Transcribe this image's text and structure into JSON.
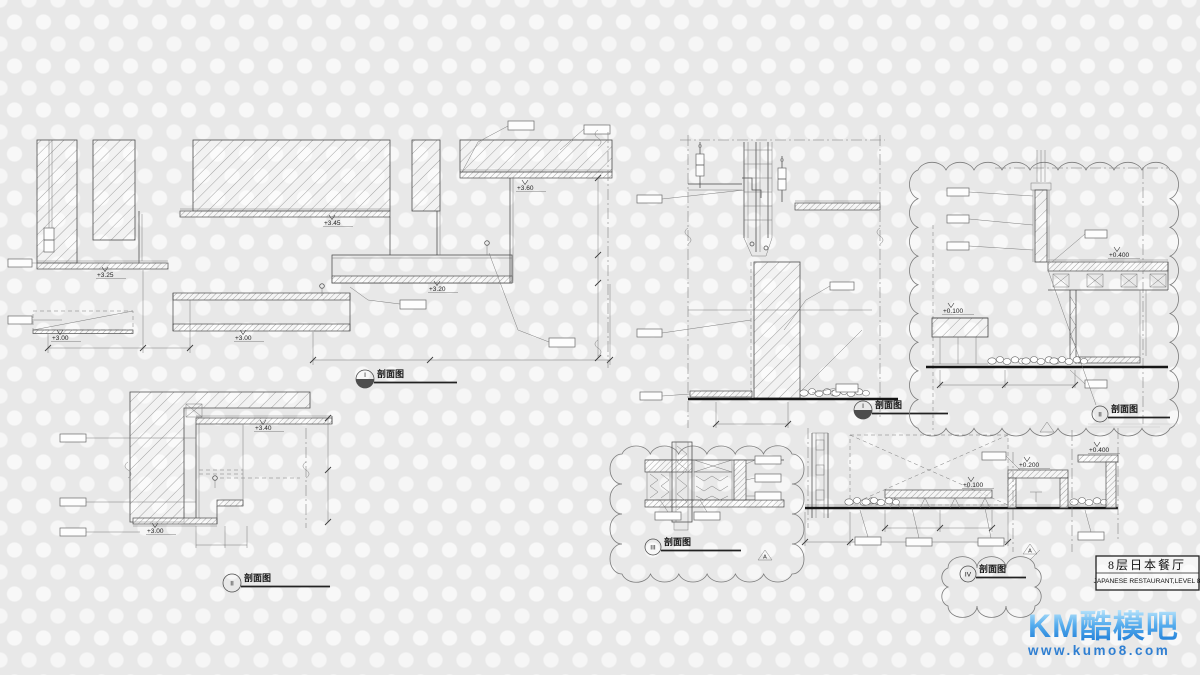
{
  "sheet": {
    "title_block": {
      "cn": "8层日本餐厅",
      "en": "JAPANESE RESTAURANT,LEVEL 8"
    }
  },
  "watermark": {
    "brand": "KM酷模吧",
    "url": "www.kumo8.com",
    "brand_color_top": "#b9e4fb",
    "brand_color_bottom": "#1f7ed8",
    "url_color": "#2f7fd2"
  },
  "marker": {
    "a": "A"
  },
  "details": {
    "d1": {
      "name": "剖面图",
      "num": "I",
      "levels": {
        "a": "+3.25",
        "b": "+3.45",
        "c": "+3.60",
        "d": "+3.20",
        "e": "+3.00",
        "f": "+3.00"
      }
    },
    "d2": {
      "name": "剖面图",
      "num": "II",
      "levels": {
        "a": "+3.40",
        "b": "+3.00"
      }
    },
    "d3": {
      "name": "剖面图",
      "num": "I"
    },
    "d4": {
      "name": "剖面图",
      "num": "II",
      "levels": {
        "a": "+0.400",
        "b": "+0.100"
      }
    },
    "d5": {
      "name": "剖面图",
      "num": "III"
    },
    "d6": {
      "name": "剖面图",
      "num": "IV",
      "levels": {
        "a": "+0.100",
        "b": "+0.200",
        "c": "+0.400"
      }
    }
  }
}
